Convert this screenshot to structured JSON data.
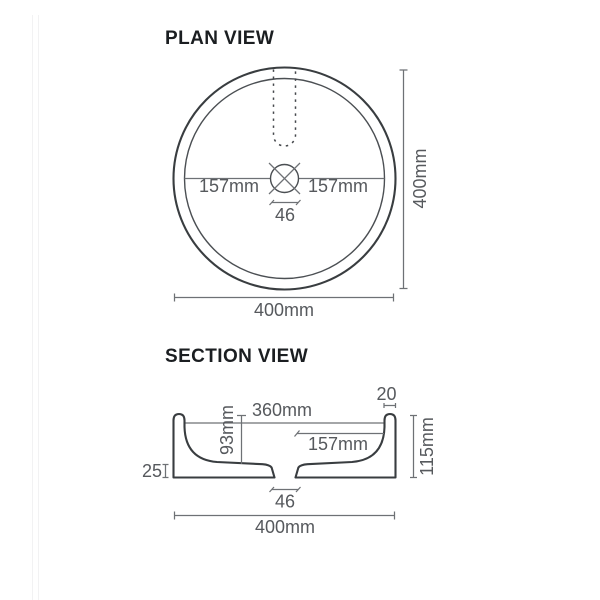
{
  "plan": {
    "title": "PLAN VIEW",
    "dim_left_radius": "157mm",
    "dim_right_radius": "157mm",
    "dim_drain_width": "46",
    "dim_overall_height": "400mm",
    "dim_overall_width": "400mm"
  },
  "section": {
    "title": "SECTION VIEW",
    "dim_inner_width": "360mm",
    "dim_wall_thickness": "20",
    "dim_bowl_depth": "93mm",
    "dim_centre_to_wall": "157mm",
    "dim_base_lip": "25",
    "dim_overall_height": "115mm",
    "dim_drain_width": "46",
    "dim_overall_width": "400mm"
  },
  "colors": {
    "background": "#ffffff",
    "basin_outline": "#393d40",
    "dimension_line": "#6e7175",
    "dimension_text": "#56595d",
    "title_text": "#1b1e21",
    "page_edge": "#f2f2f3"
  }
}
